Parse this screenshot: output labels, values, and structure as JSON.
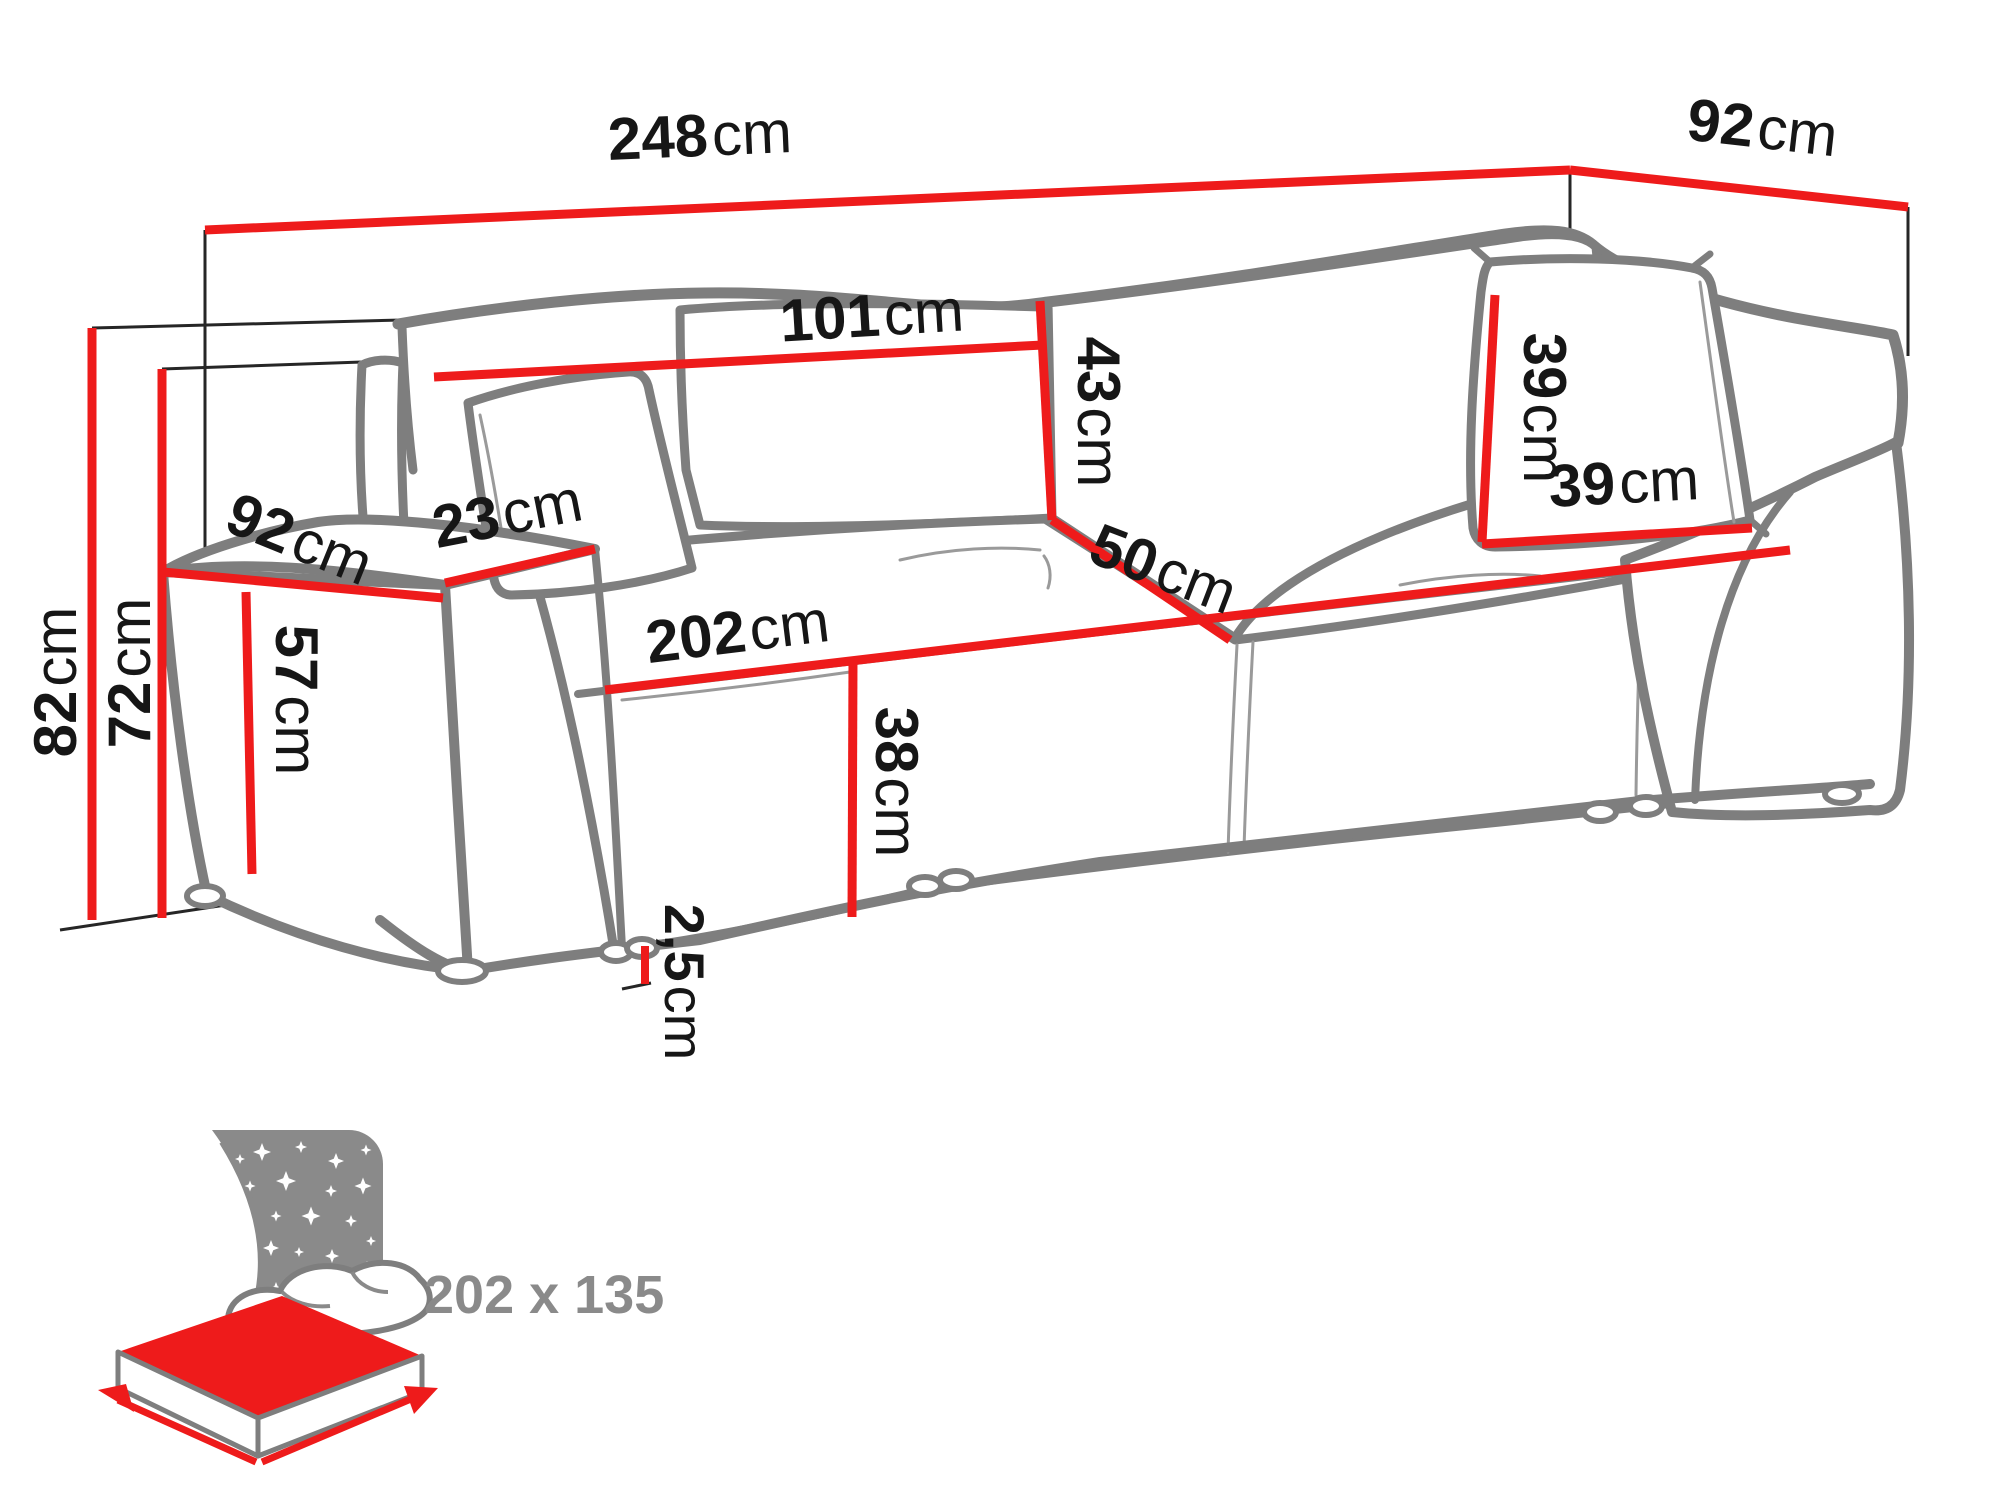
{
  "diagram": {
    "title": "sofa-bed-dimension-diagram",
    "unit": "cm",
    "dimensions": {
      "total_width": {
        "value": "248",
        "unit": "cm"
      },
      "total_depth": {
        "value": "92",
        "unit": "cm"
      },
      "back_cushion_width": {
        "value": "101",
        "unit": "cm"
      },
      "back_cushion_height": {
        "value": "43",
        "unit": "cm"
      },
      "seat_depth": {
        "value": "50",
        "unit": "cm"
      },
      "armrest_depth": {
        "value": "92",
        "unit": "cm"
      },
      "armrest_width": {
        "value": "23",
        "unit": "cm"
      },
      "total_height": {
        "value": "82",
        "unit": "cm"
      },
      "frame_height": {
        "value": "72",
        "unit": "cm"
      },
      "armrest_height": {
        "value": "57",
        "unit": "cm"
      },
      "seat_width": {
        "value": "202",
        "unit": "cm"
      },
      "seat_height": {
        "value": "38",
        "unit": "cm"
      },
      "pillow_height": {
        "value": "39",
        "unit": "cm"
      },
      "pillow_width": {
        "value": "39",
        "unit": "cm"
      },
      "leg_height": {
        "value": "2,5",
        "unit": "cm"
      }
    },
    "sleeping_function": {
      "icon": "night-sleep-mattress-icon",
      "bed_size_label": "202 x 135"
    },
    "colors": {
      "dimension_red": "#ee1b1b",
      "sketch_gray": "#7e7e7e",
      "icon_gray": "#8a8a8a",
      "label_black": "#161616",
      "background": "#ffffff"
    }
  }
}
